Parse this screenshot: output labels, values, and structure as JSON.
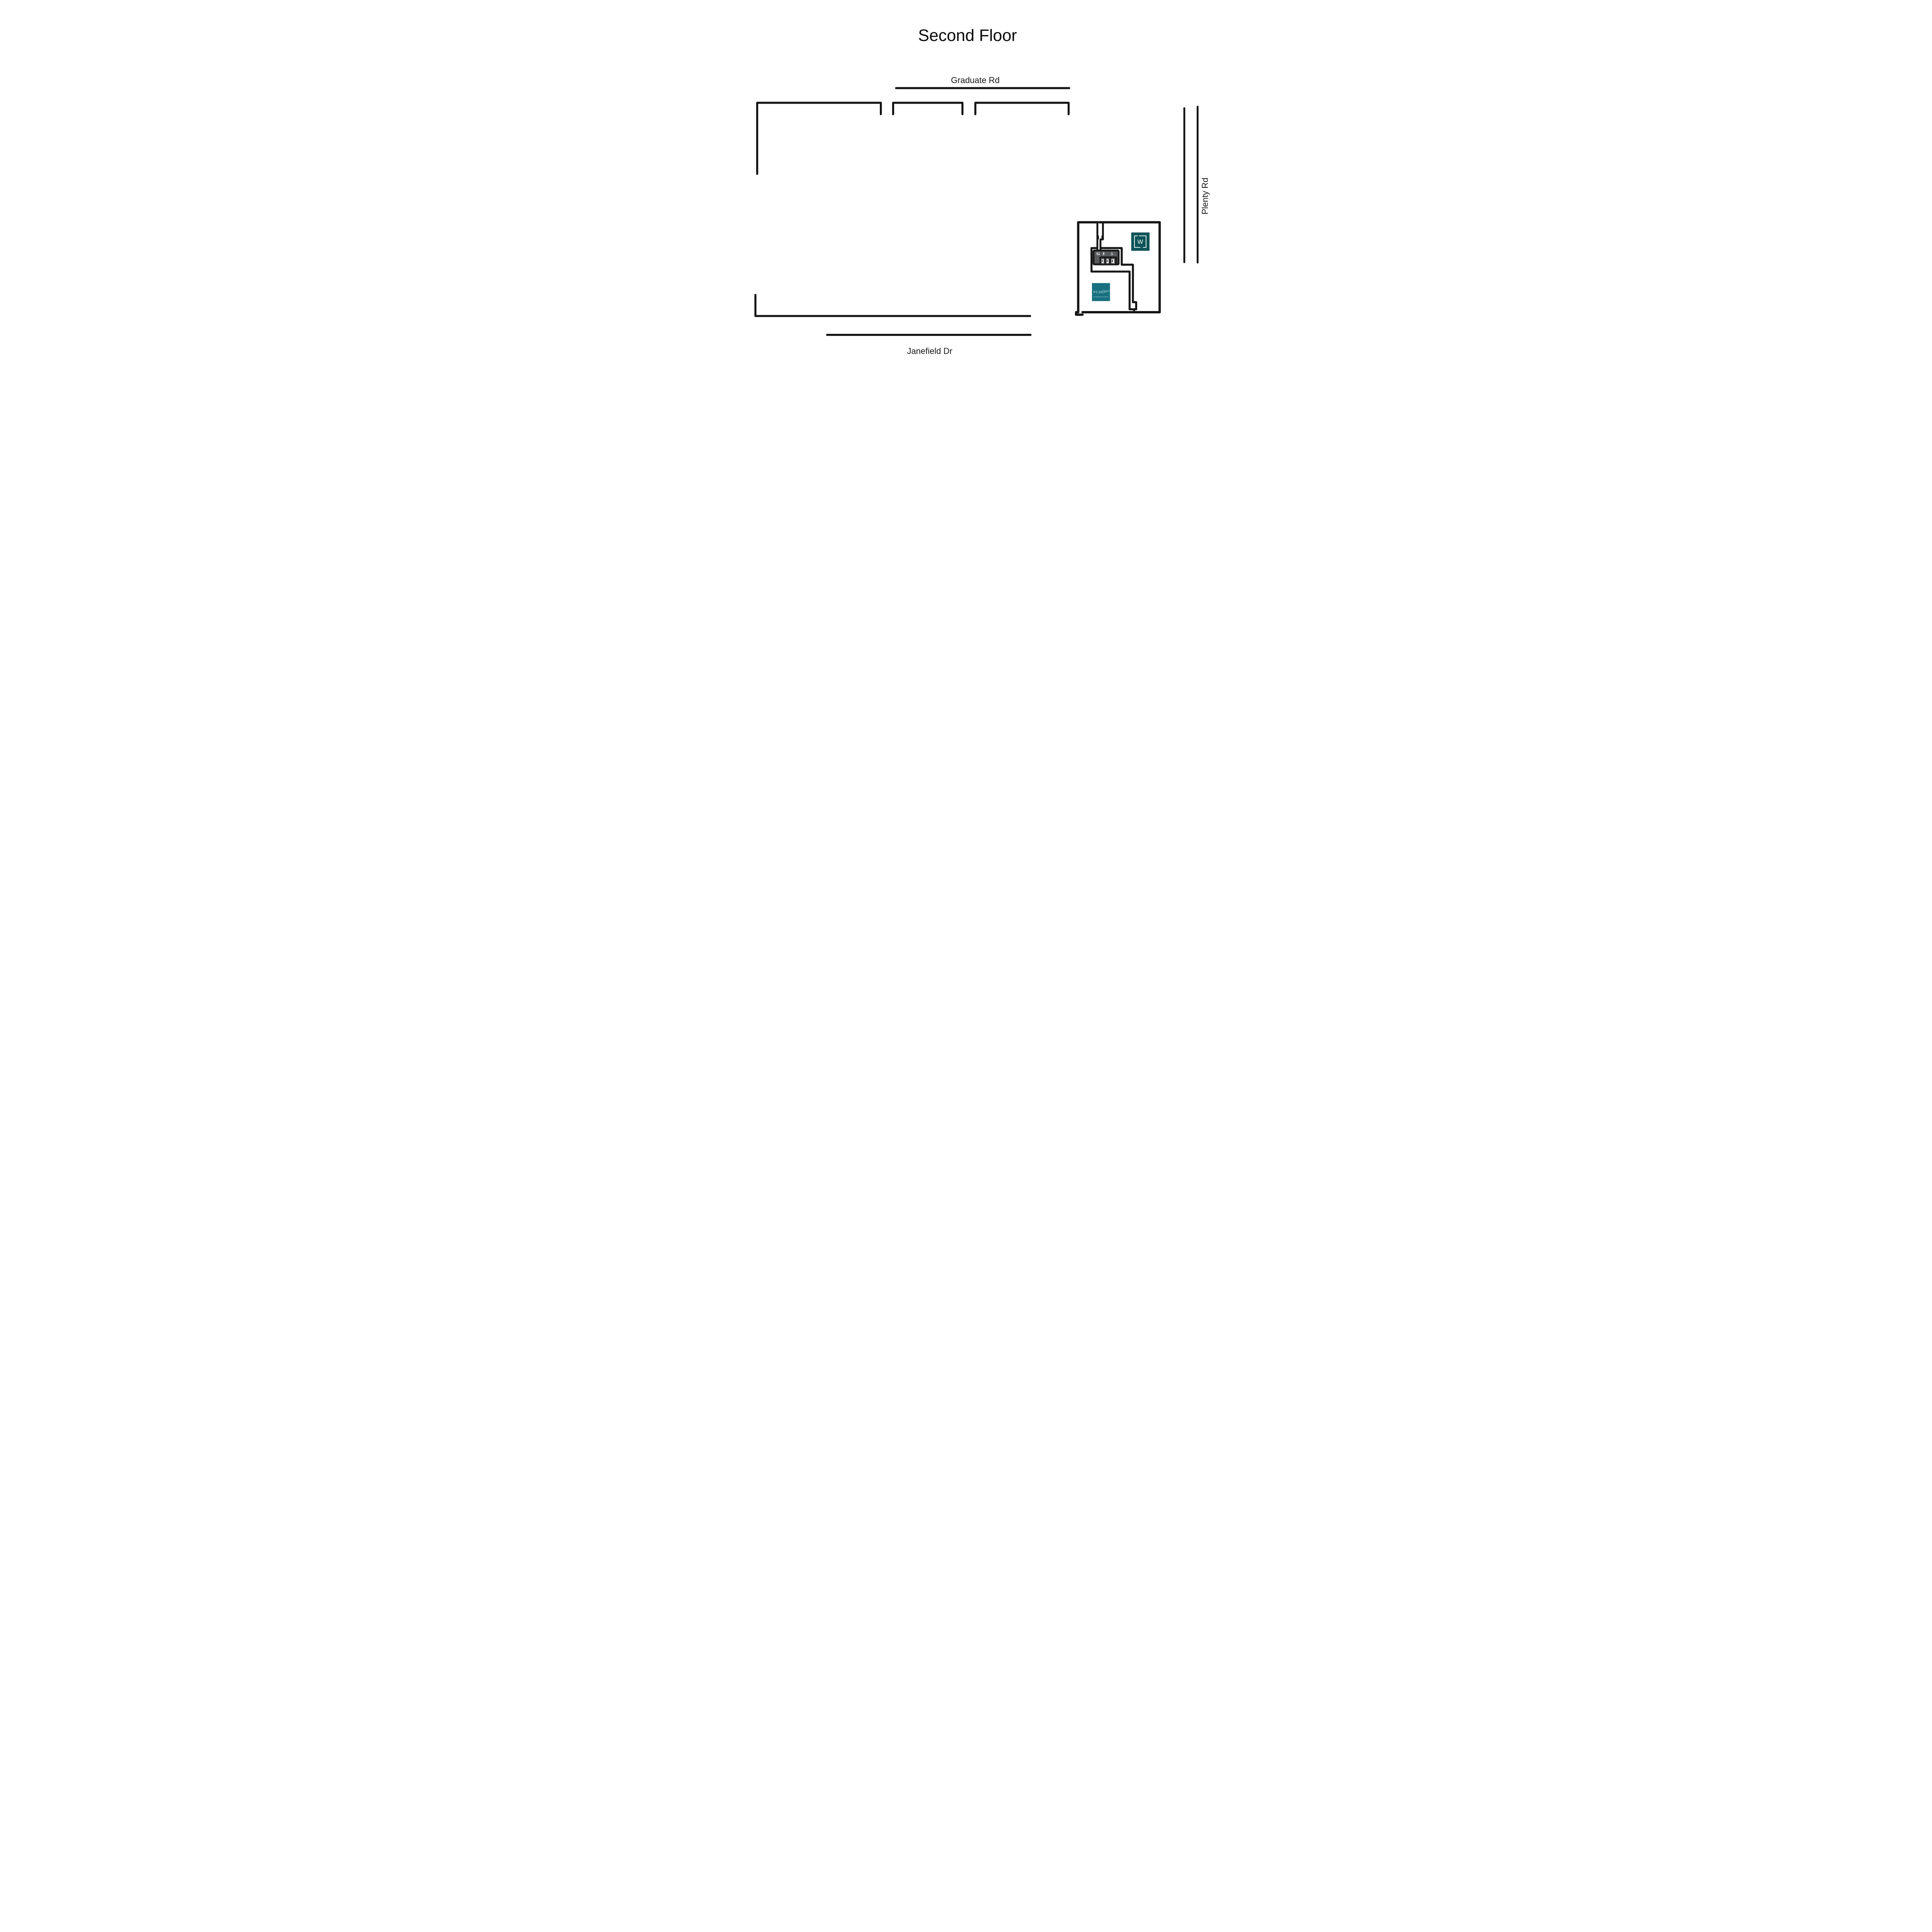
{
  "title": "Second Floor",
  "streets": {
    "graduate": "Graduate Rd",
    "plenty": "Plenty Rd",
    "janefield": "Janefield Dr"
  },
  "building": {
    "whittlesea_logo": {
      "letter": "W",
      "bg": "#0d5459"
    },
    "vcat_logo": {
      "acronym": "VCAT",
      "descriptor": [
        "victorian civil &",
        "administrative",
        "tribunal"
      ],
      "tagline": "Fair, efficient justice for all Victorians",
      "bg": "#16707f"
    },
    "facilities": {
      "sign_bg": "#58595b",
      "lift_cell_bg": "#55565a",
      "icons": [
        "male-female-toilets",
        "parent-room",
        "wheelchair-access"
      ],
      "lift_count": 3
    }
  },
  "colors": {
    "ink": "#141414",
    "background": "#ffffff"
  }
}
